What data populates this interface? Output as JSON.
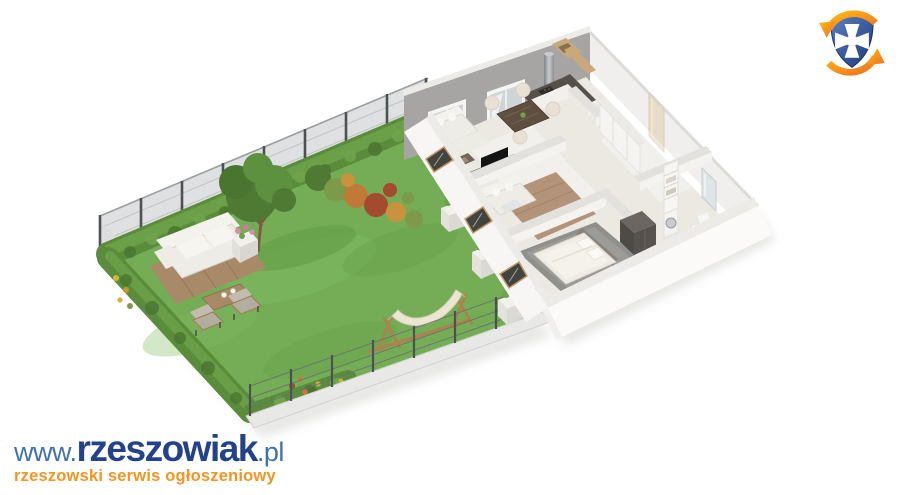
{
  "page": {
    "background": "#ffffff",
    "kind": "real-estate 3D visualization"
  },
  "branding": {
    "site_logo": {
      "www_prefix": "www.",
      "site_name": "rzeszowiak",
      "tld": ".pl",
      "tagline": "rzeszowski serwis ogłoszeniowy"
    },
    "emblem": {
      "name": "rzeszowiak-shield-emblem",
      "description": "blue shield with white cross pattée encircled by two orange swirl arrows"
    }
  },
  "scene": {
    "type": "isometric-3d-floor-plan",
    "description": "Cut-away 3D render of a ground-floor apartment with a private fenced garden",
    "garden_elements": [
      "lawn",
      "hedge",
      "mesh-fence",
      "tree",
      "autumn-shrubs",
      "flower-bed",
      "wooden-deck",
      "outdoor-sofa",
      "coffee-table",
      "armchairs",
      "flower-planter",
      "hammock",
      "wall-planters"
    ],
    "apartment_rooms": [
      "living-room",
      "dining-area",
      "kitchen",
      "hallway",
      "second-room",
      "bedroom",
      "bathroom"
    ],
    "apartment_furniture": [
      "corner-sofa",
      "tv-console",
      "coffee-table",
      "dining-table",
      "dining-chairs",
      "kitchen-counter",
      "range-hood",
      "wall-cabinets",
      "second-sofa",
      "double-bed",
      "dark-wardrobe",
      "hall-wardrobe",
      "shelf-tower",
      "washing-machine",
      "toilet",
      "mirror-panel",
      "terrace-glass-doors",
      "windows",
      "entry-door"
    ]
  },
  "colors": {
    "background": "#ffffff",
    "grass": "#74ad55",
    "grass_light": "#82bb63",
    "grass_dark": "#619a45",
    "hedge": "#5a8c3c",
    "hedge_light": "#6fa44b",
    "hedge_dark": "#4a7530",
    "foliage": "#4e7a33",
    "foliage_light": "#5d9140",
    "autumn_orange": "#c07a36",
    "autumn_red": "#a34b2e",
    "autumn_gold": "#c9923e",
    "shrub_green": "#7d9a4a",
    "fence_mesh": "#dcdedf",
    "fence_post": "#4c5154",
    "curb": "#e8e8e6",
    "wall_gray": "#a6a5a3",
    "wall_white": "#f7f6f4",
    "wall_top": "#ecebe8",
    "wall_bright": "#fbfaf8",
    "partition_top": "#e2e1dd",
    "partition_side": "#f4f3f0",
    "floor_marble": "#ece9e3",
    "floor_wood": "#b3937a",
    "wood_line": "#a08064",
    "rug_gray": "#8f8f8c",
    "counter_dark": "#57504a",
    "cabinet_wood": "#c9a87c",
    "steel": "#9fa3a6",
    "sofa_white": "#edece6",
    "sofa_hi": "#f3f2ed",
    "cushion": "#b3aca0",
    "chair_cream": "#e8e1d4",
    "bed_linen": "#efece5",
    "headboard": "#8a8178",
    "wardrobe_dark": "#57524d",
    "table_wood": "#5f4f41",
    "deck_wood": "#a98a68",
    "deck_line": "#96775a",
    "hammock_canvas": "#ece5d2",
    "hammock_wood": "#a8854f",
    "planter_white": "#f1f0ec",
    "glass": "#cfd5d6",
    "door_glass": "#44443f",
    "door_frame": "#c2996b",
    "shadow": "#d4d4d2",
    "logo_blue": "#4073ad",
    "logo_blue_dark": "#24418c",
    "logo_orange": "#f5941f",
    "emblem_blue": "#2b4d94",
    "emblem_blue_dark": "#1d3468",
    "emblem_orange": "#f26f21",
    "emblem_yellow": "#fdb913"
  }
}
